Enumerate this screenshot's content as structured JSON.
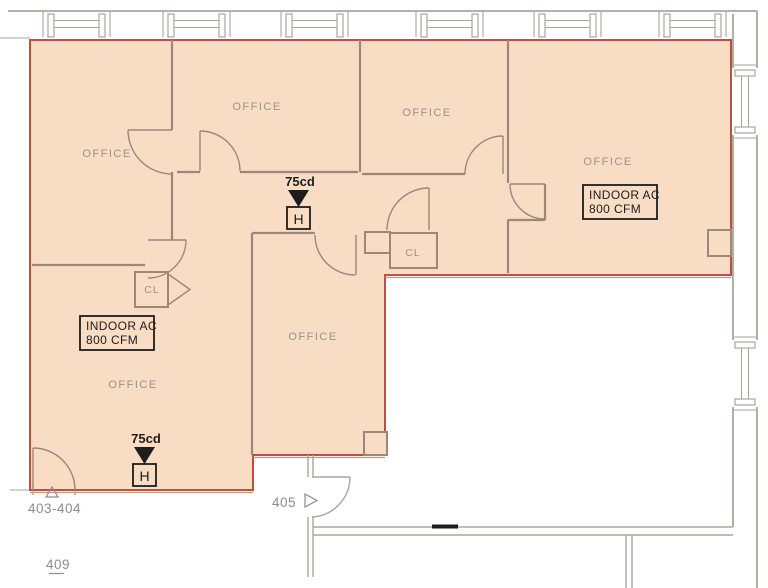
{
  "plan": {
    "type": "architectural-floor-plan",
    "colors": {
      "suite_fill": "#f8dcc3",
      "suite_border": "#bf4f45",
      "wall_color": "#9c8876",
      "exterior_color": "#a9a6a1",
      "room_label_color": "#97948b",
      "tag_color": "#8c8c8c",
      "ink_color": "#1d1d1d"
    },
    "rooms": [
      {
        "label": "OFFICE"
      },
      {
        "label": "OFFICE"
      },
      {
        "label": "OFFICE"
      },
      {
        "label": "OFFICE"
      },
      {
        "label": "OFFICE"
      },
      {
        "label": "OFFICE"
      }
    ],
    "closets": [
      {
        "label": "CL"
      },
      {
        "label": "CL"
      }
    ],
    "ac_units": [
      {
        "line1": "INDOOR AC",
        "line2": "800 CFM"
      },
      {
        "line1": "INDOOR AC",
        "line2": "800 CFM"
      }
    ],
    "horn_devices": [
      {
        "label": "75cd",
        "letter": "H"
      },
      {
        "label": "75cd",
        "letter": "H"
      }
    ],
    "door_tags": [
      {
        "label": "403-404"
      },
      {
        "label": "405"
      },
      {
        "label": "409"
      }
    ]
  }
}
